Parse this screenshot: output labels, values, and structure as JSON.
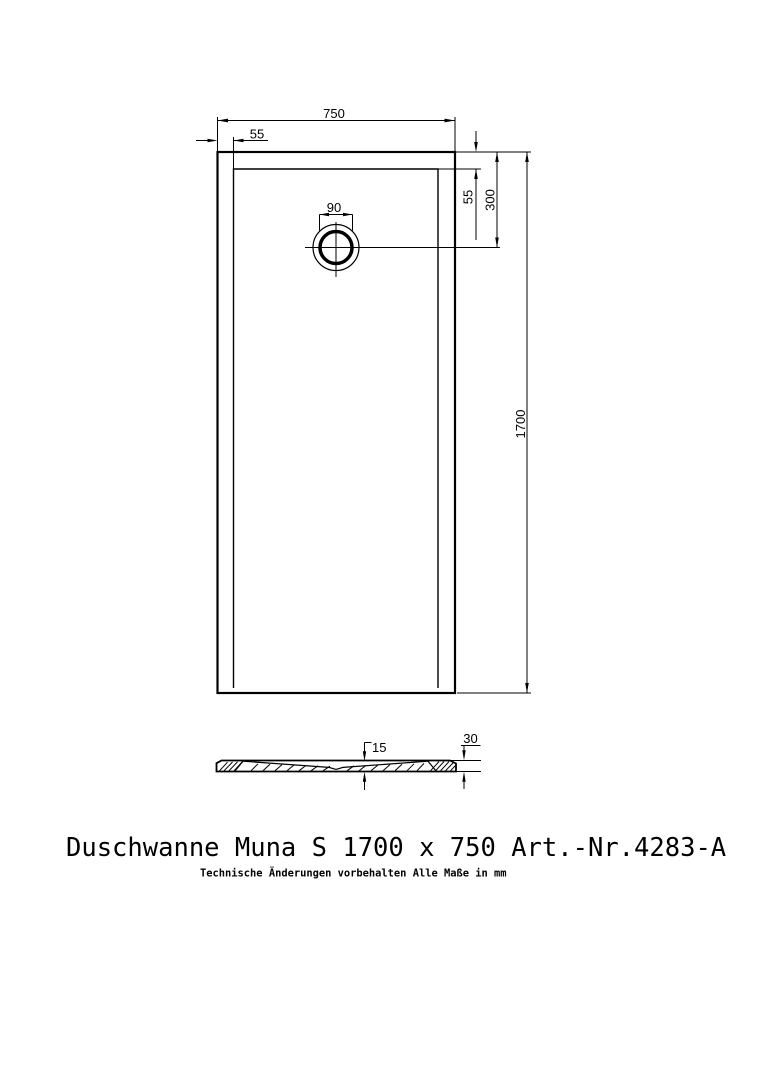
{
  "page": {
    "background": "#ffffff",
    "line_color": "#000000"
  },
  "title_block": {
    "title": "Duschwanne Muna S 1700 x 750 Art.-Nr.4283-A",
    "disclaimer": "Technische Änderungen vorbehalten  Alle Maße in mm"
  },
  "plan_view": {
    "dimensions": {
      "overall_width_mm": "750",
      "rim_offset_left_mm": "55",
      "rim_offset_top_mm": "55",
      "drain_center_from_top_mm": "300",
      "overall_length_mm": "1700",
      "drain_diameter_mm": "90"
    }
  },
  "section_view": {
    "dimensions": {
      "floor_thickness_mm": "15",
      "total_height_mm": "30"
    }
  }
}
